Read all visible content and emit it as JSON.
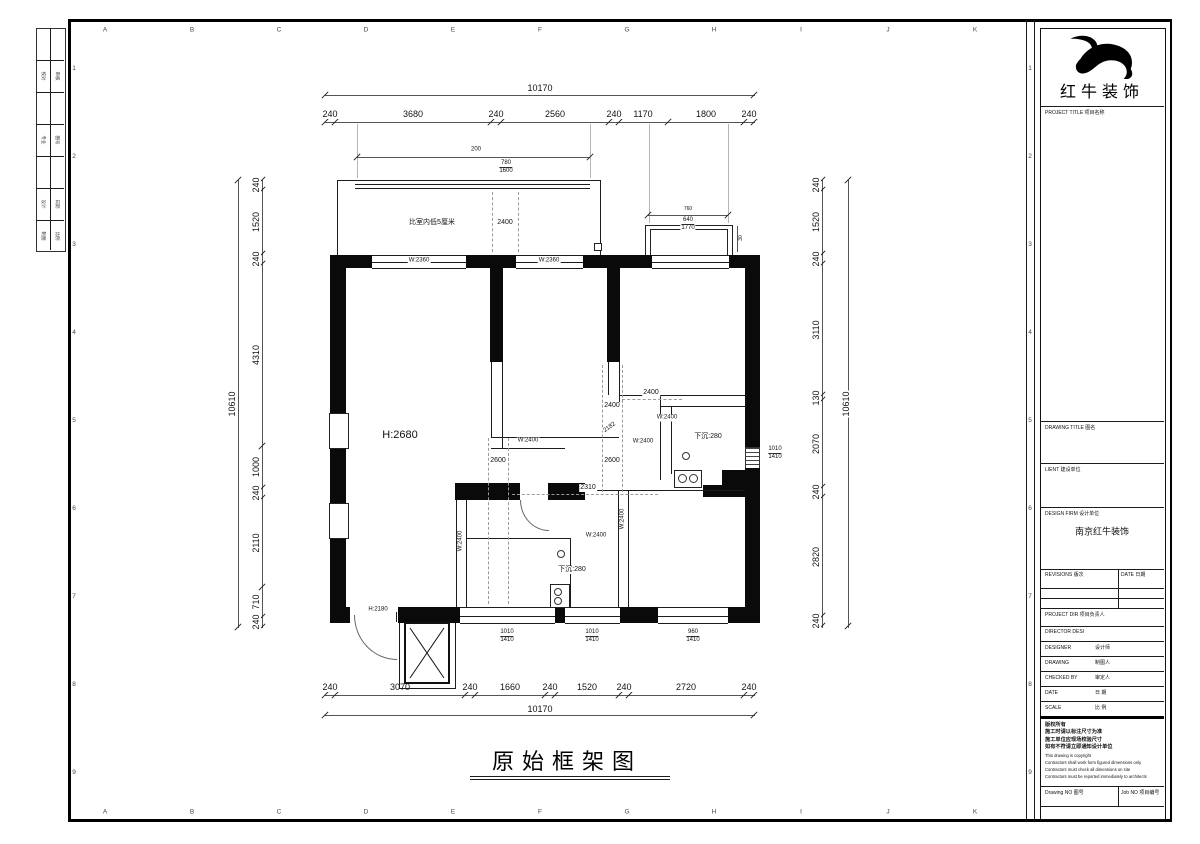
{
  "sheet": {
    "grid_letters": [
      "A",
      "B",
      "C",
      "D",
      "E",
      "F",
      "G",
      "H",
      "I",
      "J",
      "K"
    ],
    "grid_numbers": [
      "1",
      "2",
      "3",
      "4",
      "5",
      "6",
      "7",
      "8",
      "9"
    ],
    "margin_rows": [
      [
        "校对",
        "审核"
      ],
      [
        "专业",
        "图号"
      ],
      [
        "设计",
        "日期"
      ],
      [
        "制图",
        "比例"
      ]
    ]
  },
  "plan": {
    "title": "原始框架图",
    "top_overall": "10170",
    "top_dims": [
      "240",
      "3680",
      "240",
      "2560",
      "240",
      "1170",
      "1800",
      "240"
    ],
    "bottom_dims": [
      "240",
      "3070",
      "240",
      "1660",
      "240",
      "1520",
      "240",
      "2720",
      "240"
    ],
    "bottom_overall": "10170",
    "left_dims": [
      "240",
      "1520",
      "240",
      "4310",
      "1000",
      "240",
      "2110",
      "710",
      "240"
    ],
    "left_overall": "10610",
    "right_dims": [
      "240",
      "1520",
      "240",
      "3110",
      "130",
      "2070",
      "240",
      "2820",
      "240"
    ],
    "right_overall": "10610",
    "balcony": {
      "note": "比室内低5厘米",
      "dim": "200",
      "sill_top": "780",
      "sill_bottom": "1600",
      "inner": "2400"
    },
    "bay": {
      "d1": "760",
      "d2": "640",
      "d3": "1770",
      "side": "30"
    },
    "labels": {
      "win2360": "W:2360",
      "w2400": "W:2400",
      "h2680": "H:2680",
      "h2180": "H:2180",
      "sunken": "下沉:280",
      "d2600": "2600",
      "d2400": "2400",
      "d2310": "2310",
      "d2182": "2182"
    },
    "sills": {
      "s1": {
        "t": "1010",
        "b": "1410"
      },
      "s2": {
        "t": "1010",
        "b": "1410"
      },
      "s3": {
        "t": "960",
        "b": "1410"
      },
      "s4": {
        "t": "1010",
        "b": "1410"
      }
    }
  },
  "titleblock": {
    "company": "红牛装饰",
    "project_title_label": "PROJECT TITLE  项目名称",
    "drawing_title_label": "DRAWING TITLE  图名",
    "client_label": "LIENT  建设单位",
    "design_firm_label": "DESIGN FIRM  设计单位",
    "design_firm_value": "南京红牛装饰",
    "revisions_label": "REVISIONS  版次",
    "date_col_label": "DATE  日期",
    "project_dir_label": "PROJECT DIR  项目负责人",
    "director_label": "DIRECTOR DESI",
    "designer_label": "DESIGNER",
    "designer_cn": "设计师",
    "drawing_label": "DRAWING",
    "drawing_cn": "制图人",
    "checked_label": "CHECKED BY",
    "checked_cn": "审定人",
    "date_label": "DATE",
    "date_cn": "日 期",
    "scale_label": "SCALE",
    "scale_cn": "比 例",
    "notes": [
      "版权所有",
      "施工时请以标注尺寸为准",
      "施工单位应现场校验尺寸",
      "如有不符请立即通知设计单位",
      "This drawing is copyright",
      "Contractors shall work form figured dimensions only",
      "Contractors must check all dimensions on site",
      "Contractors must be reported immediately to architects"
    ],
    "drawing_no_label": "Drawing NO  图号",
    "job_no_label": "Job NO  项目编号"
  }
}
